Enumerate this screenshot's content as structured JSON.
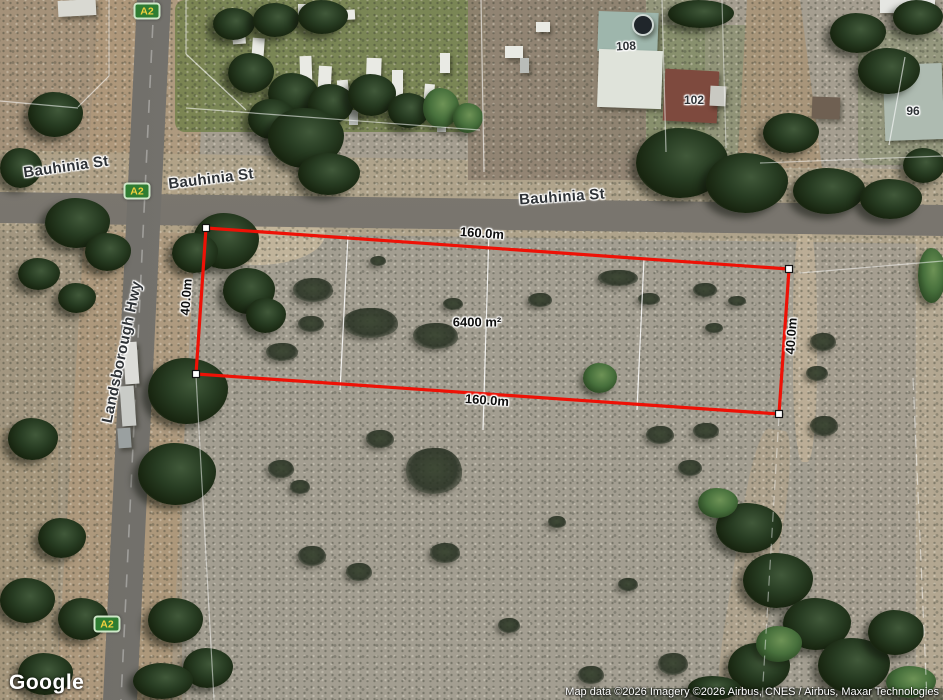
{
  "map_type": "satellite",
  "roads": {
    "bauhinia_left": "Bauhinia St",
    "bauhinia_mid": "Bauhinia St",
    "bauhinia_right": "Bauhinia St",
    "landsborough": "Landsborough Hwy"
  },
  "route_badges": {
    "top": "A2",
    "middle": "A2",
    "bottom": "A2"
  },
  "houses": {
    "h108": "108",
    "h102": "102",
    "h96": "96"
  },
  "parcel": {
    "top_width": "160.0m",
    "bottom_width": "160.0m",
    "left_depth": "40.0m",
    "right_depth": "40.0m",
    "area": "6400 m²",
    "outline_color": "#ee1106"
  },
  "branding": {
    "logo_text": "Google"
  },
  "attribution": {
    "text": "Map data ©2026 Imagery ©2026 Airbus, CNES / Airbus, Maxar Technologies"
  },
  "colors": {
    "badge_bg": "#2e7d32",
    "badge_text": "#f2d13e",
    "boundary_line": "#ffffff"
  }
}
